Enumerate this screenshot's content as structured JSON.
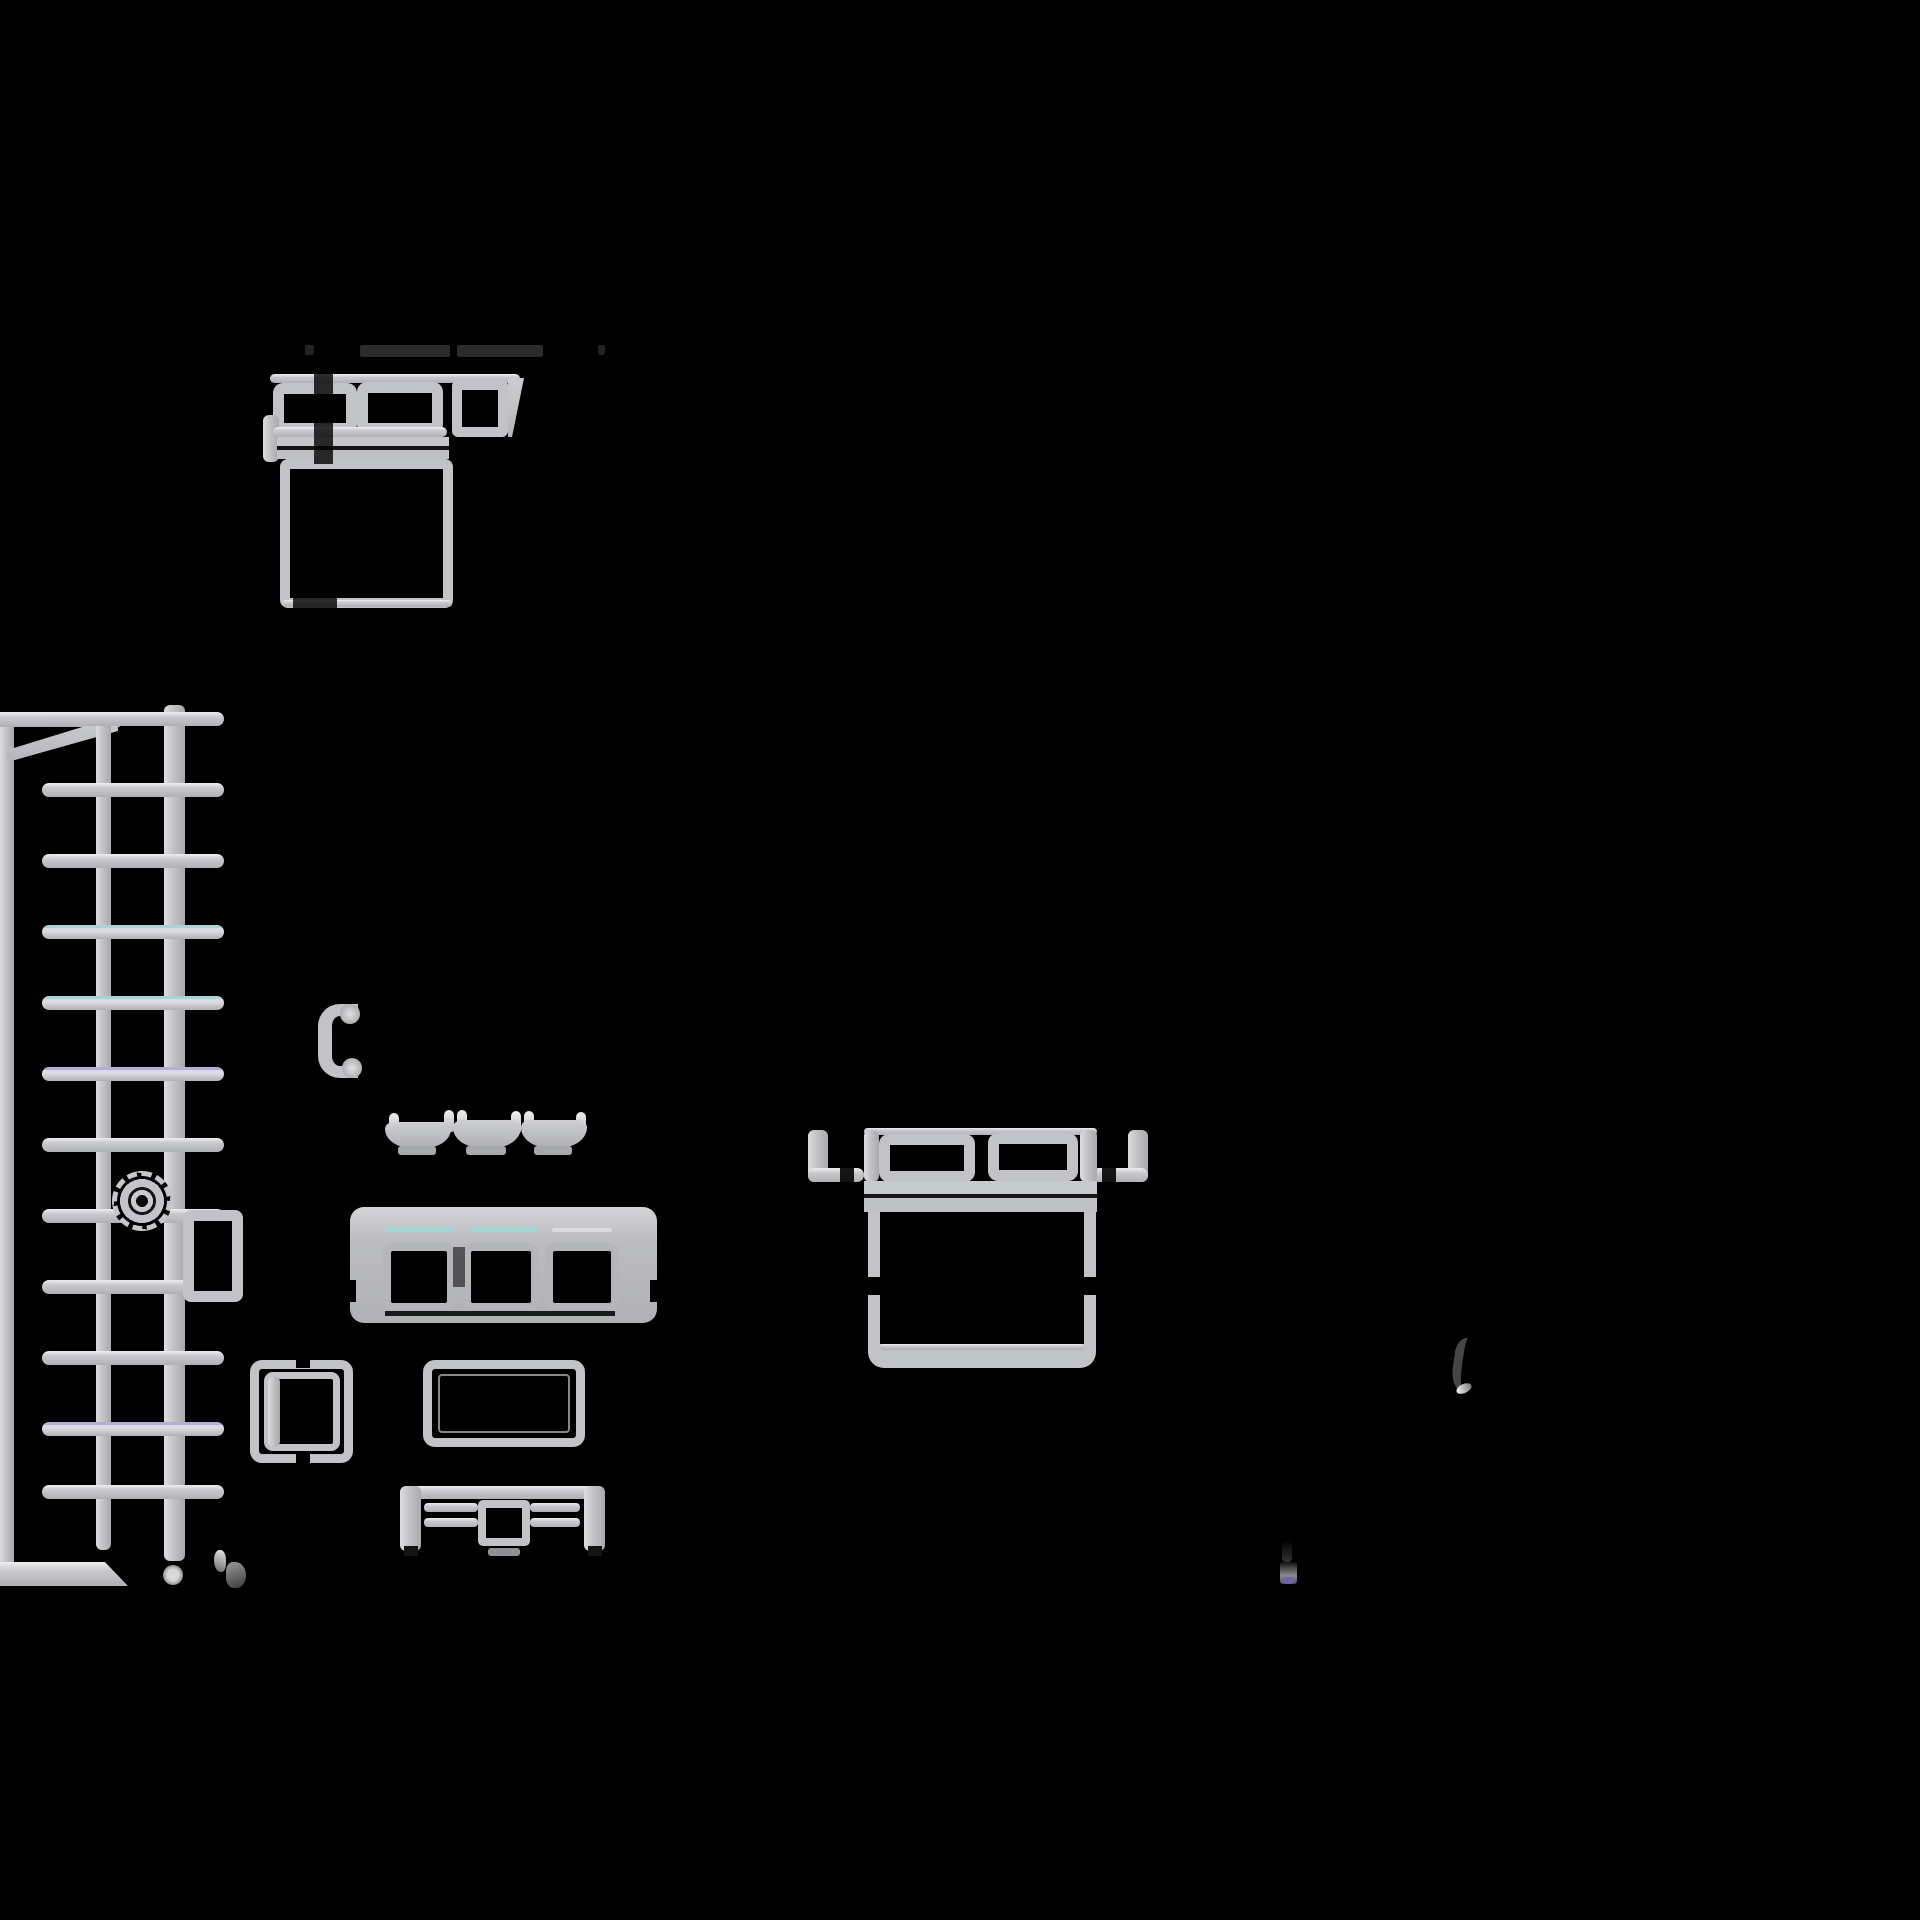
{
  "canvas": {
    "width": 1920,
    "height": 1920,
    "background": "#000000"
  },
  "palette": {
    "stroke": "#c2c3c6",
    "stroke_bright": "#efeff1",
    "stroke_dim": "#8f9093",
    "accent_cyan": "#9fd8d4",
    "accent_lavender": "#b6addc",
    "accent_purple": "#6f64a8",
    "shadow_smudge": "#2c2c2e",
    "background": "#000000"
  },
  "plan": {
    "description": "Top-down furniture layout symbols drawn in light gray on a black background",
    "regions": [
      {
        "name": "bed-top-left",
        "kind": "bed-plan-symbol",
        "parts": [
          "headboard-rail",
          "pillow",
          "pillow",
          "open-square",
          "folded-corner",
          "blanket-band",
          "bed-body",
          "side-hook"
        ]
      },
      {
        "name": "redacted-label-row",
        "kind": "dark-smudge-text"
      },
      {
        "name": "shelving-lattice",
        "kind": "wall-with-trellis",
        "rungs": 12,
        "rails": 2,
        "extras": [
          "fan-gear-symbol",
          "side-box",
          "foot-caster",
          "corner-wall"
        ]
      },
      {
        "name": "curved-bracket",
        "kind": "c-bracket-symbol"
      },
      {
        "name": "garland",
        "kind": "swag-wavy-line",
        "swags": 3
      },
      {
        "name": "sofa",
        "kind": "three-seat-sofa-plan",
        "cushions": 3
      },
      {
        "name": "side-table",
        "kind": "square-table-double-border"
      },
      {
        "name": "coffee-table",
        "kind": "rect-table-double-border"
      },
      {
        "name": "tv-console",
        "kind": "media-console-with-tv"
      },
      {
        "name": "bed-right",
        "kind": "bed-plan-symbol",
        "parts": [
          "side-hook",
          "post",
          "pillow",
          "pillow",
          "blanket-band",
          "bed-body",
          "post",
          "side-hook"
        ]
      },
      {
        "name": "faint-arc",
        "kind": "dim-curved-stroke"
      },
      {
        "name": "purple-dot-marker",
        "kind": "small-blob-with-purple-dot"
      }
    ]
  }
}
